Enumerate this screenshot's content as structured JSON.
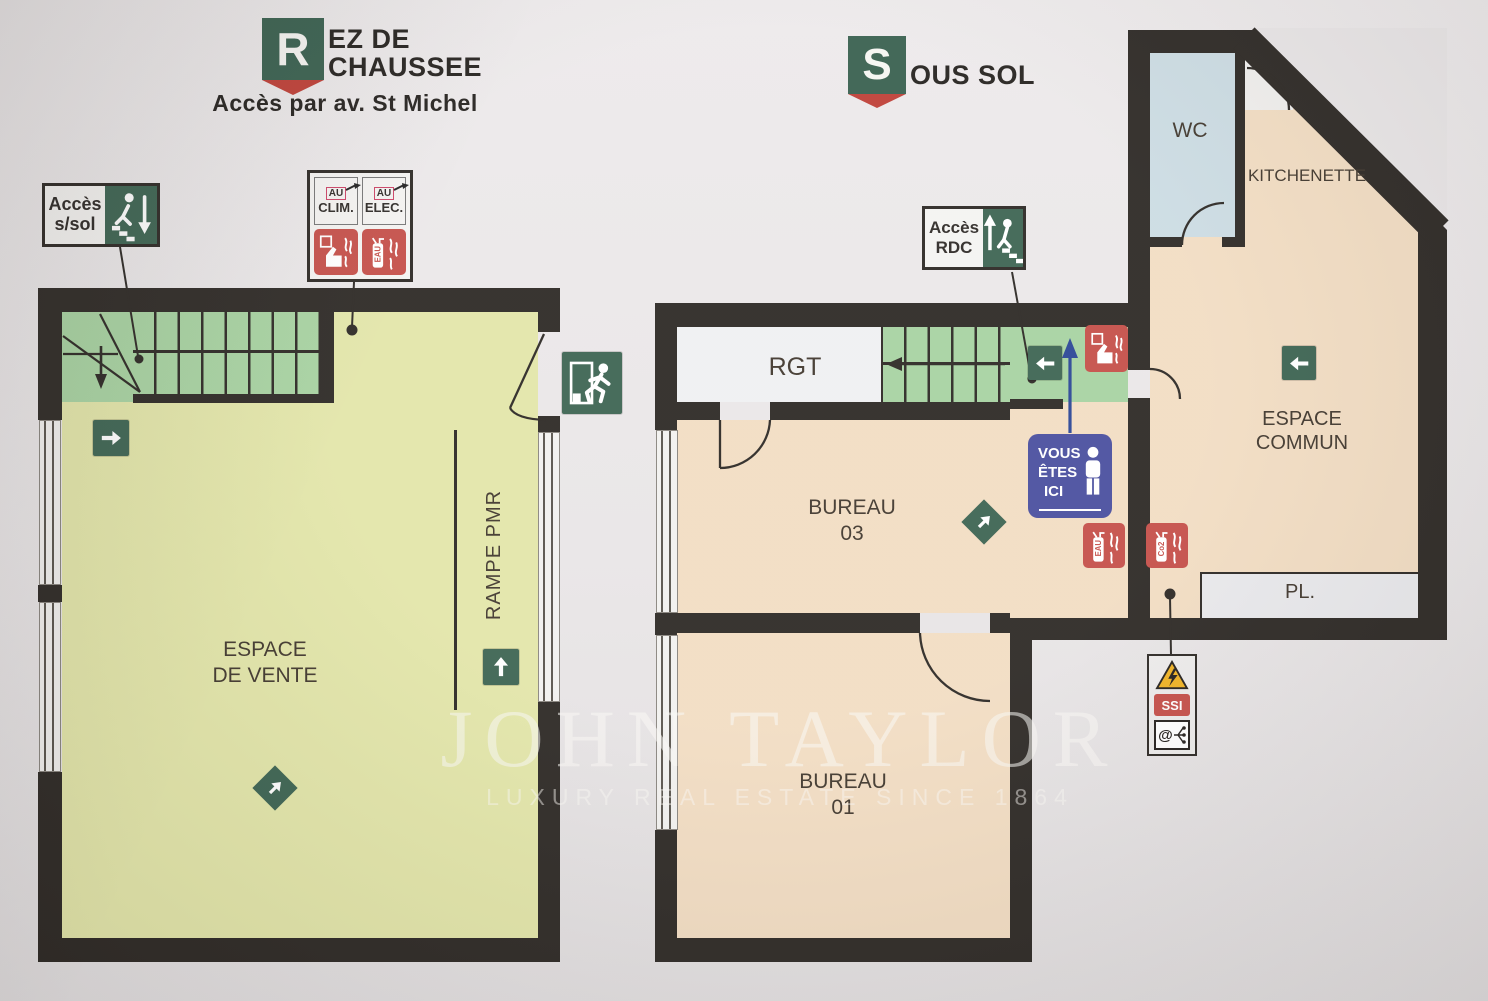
{
  "colors": {
    "wall": "#2e2a26",
    "ground_floor_fill": "#e3e6aa",
    "basement_fill": "#f2ddc3",
    "stairs_fill": "#a8d3a2",
    "safety_green": "#3e6553",
    "safety_red": "#c5504a",
    "location_blue": "#4b509f",
    "wc_fill": "#ccdce3",
    "closet_fill": "#e9e9ec",
    "hazard_yellow": "#f0b325"
  },
  "watermark": {
    "title": "JOHN TAYLOR",
    "tagline": "LUXURY REAL ESTATE SINCE 1864"
  },
  "ground_floor": {
    "badge_letter": "R",
    "title_line1": "EZ DE",
    "title_line2": "CHAUSSEE",
    "subtitle": "Accès par av. St Michel",
    "acces_ssol": {
      "line1": "Accès",
      "line2": "s/sol"
    },
    "utilities_sign": {
      "clim_prefix": "AU",
      "clim_label": "CLIM.",
      "elec_prefix": "AU",
      "elec_label": "ELEC.",
      "extinguisher_label": "EAU"
    },
    "rooms": {
      "espace_vente_line1": "ESPACE",
      "espace_vente_line2": "DE VENTE",
      "rampe": "RAMPE PMR"
    }
  },
  "basement": {
    "badge_letter": "S",
    "title": "OUS SOL",
    "acces_rdc": {
      "line1": "Accès",
      "line2": "RDC"
    },
    "vous_etes_ici": {
      "line1": "VOUS",
      "line2": "ÊTES",
      "line3": "ICI"
    },
    "rooms": {
      "rgt": "RGT",
      "wc": "WC",
      "kitchenette": "KITCHENETTE",
      "espace_commun_line1": "ESPACE",
      "espace_commun_line2": "COMMUN",
      "pl": "PL.",
      "bureau03_line1": "BUREAU",
      "bureau03_line2": "03",
      "bureau01_line1": "BUREAU",
      "bureau01_line2": "01"
    },
    "extinguishers": {
      "eau": "EAU",
      "co2": "Co2"
    },
    "tech_sign": {
      "ssi": "SSI",
      "at": "@"
    }
  }
}
